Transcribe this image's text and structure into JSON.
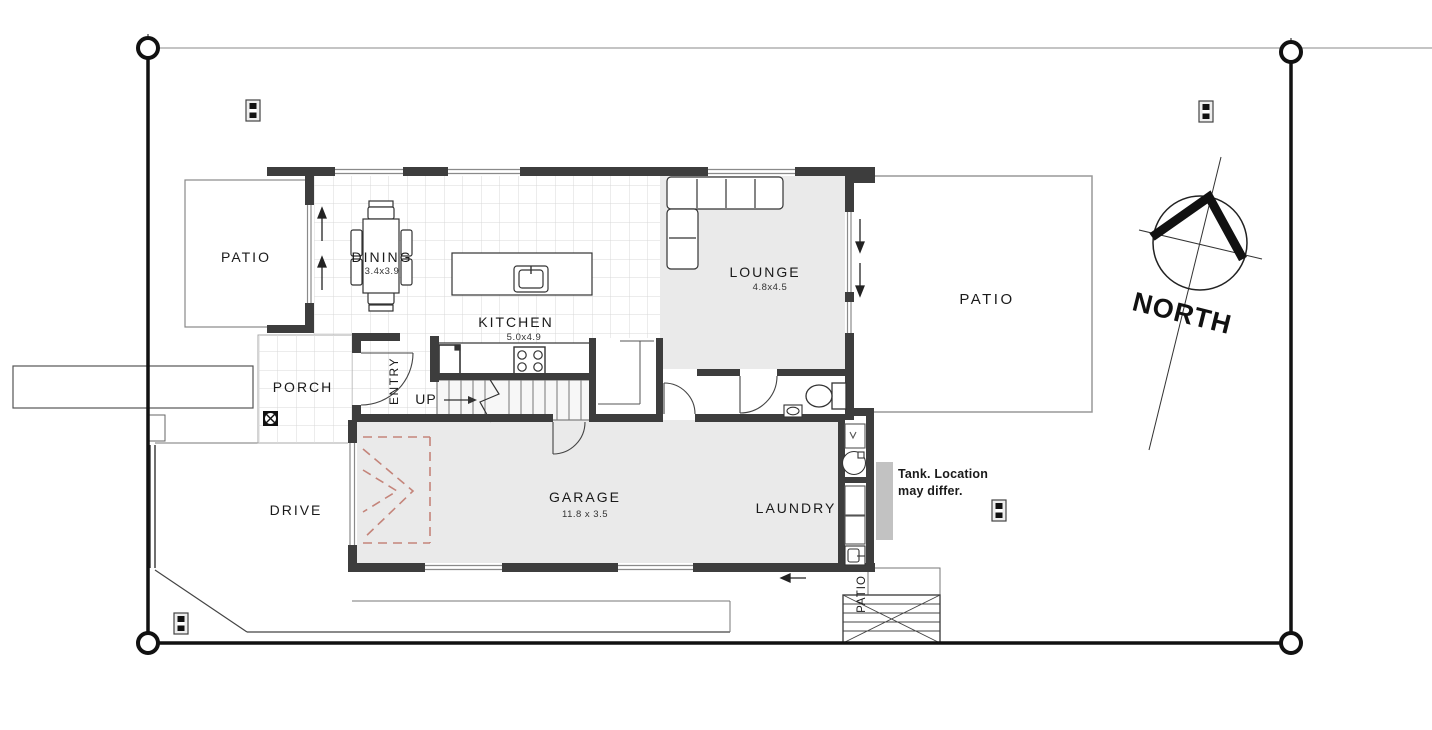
{
  "rooms": {
    "patio_left": {
      "label": "PATIO"
    },
    "patio_right": {
      "label": "PATIO"
    },
    "patio_bottom": {
      "label": "PATIO"
    },
    "dining": {
      "label": "DINING",
      "dims": "3.4x3.9"
    },
    "kitchen": {
      "label": "KITCHEN",
      "dims": "5.0x4.9"
    },
    "lounge": {
      "label": "LOUNGE",
      "dims": "4.8x4.5"
    },
    "porch": {
      "label": "PORCH"
    },
    "entry": {
      "label": "ENTRY"
    },
    "stairs": {
      "label": "UP"
    },
    "garage": {
      "label": "GARAGE",
      "dims": "11.8 x 3.5"
    },
    "laundry": {
      "label": "LAUNDRY"
    },
    "drive": {
      "label": "DRIVE"
    }
  },
  "compass": {
    "label": "NORTH"
  },
  "note": {
    "line1": "Tank. Location",
    "line2": "may differ."
  },
  "colors": {
    "wall": "#3d3d3d",
    "floor_gray": "#eaeaea",
    "tile_line": "#d9d9d9",
    "garage_door_dashed": "#c4847a",
    "tank": "#c2c2c2",
    "boundary": "#111111"
  }
}
